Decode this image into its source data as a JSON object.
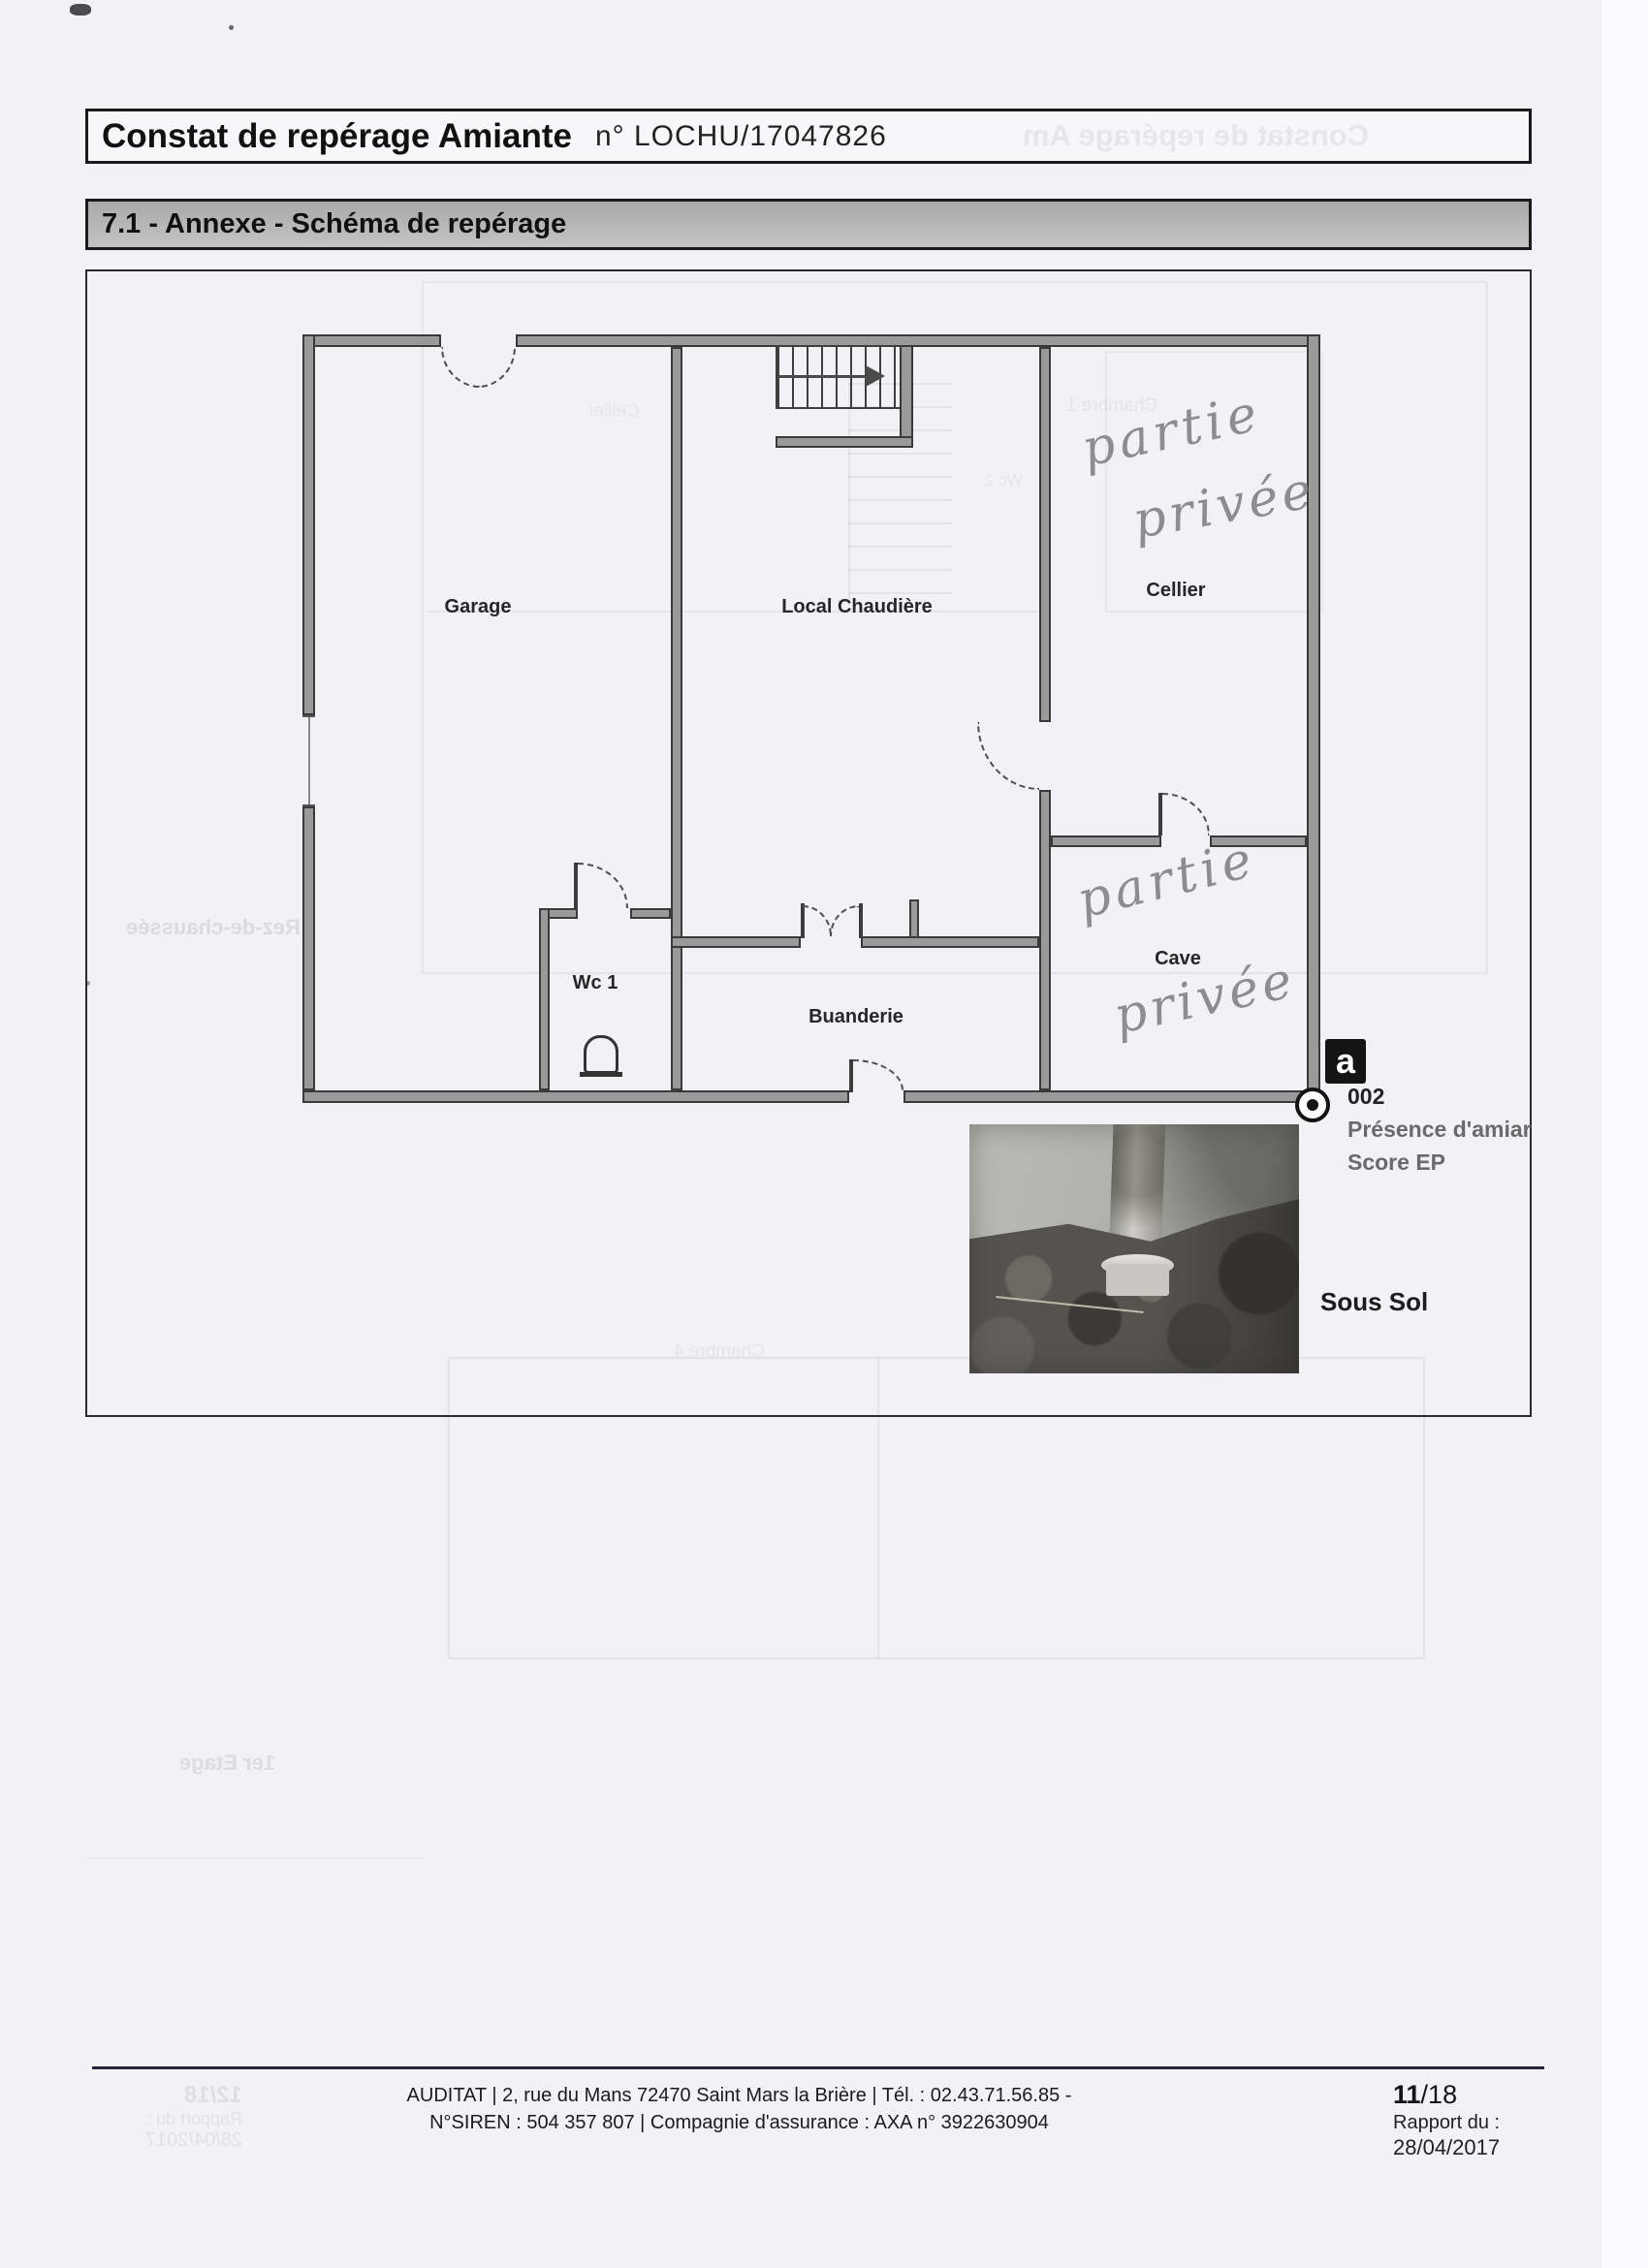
{
  "colors": {
    "paper": "#f1f1f6",
    "ink": "#1a1a1a",
    "wall_fill": "#9a9a9a",
    "wall_edge": "#3a3a3a",
    "section_bar_gray": "#b5b5b5",
    "handwriting_gray": "#76767c",
    "legend_gray": "#6a6a6a"
  },
  "header": {
    "title": "Constat de repérage Amiante",
    "doc_number": "n° LOCHU/17047826"
  },
  "section": {
    "title": "7.1 - Annexe - Schéma de repérage"
  },
  "plan": {
    "rooms": {
      "garage": "Garage",
      "local_chaudiere": "Local Chaudière",
      "cellier": "Cellier",
      "wc1": "Wc 1",
      "buanderie": "Buanderie",
      "cave": "Cave"
    },
    "handwriting": {
      "cellier_word1": "partie",
      "cellier_word2": "privée",
      "cave_word1": "partie",
      "cave_word2": "privée"
    },
    "legend": {
      "marker_letter": "a",
      "marker_id": "002",
      "description_line1": "Présence d'amiar",
      "description_line2": "Score EP"
    },
    "level_label": "Sous Sol"
  },
  "ghosts": {
    "header_title": "Constat de repérage Am",
    "rez_de_chaussee": "Rez-de-chaussée",
    "premier_etage": "1er Etage",
    "chambre1": "Chambre 1",
    "cellier": "Cellier",
    "wc2": "Wc 2",
    "chambre4": "Chambre 4",
    "page_number": "12/18",
    "report_label": "Rapport du :",
    "report_date": "28/04/2017"
  },
  "footer": {
    "line1": "AUDITAT | 2, rue du Mans 72470 Saint Mars la Brière | Tél. : 02.43.71.56.85 -",
    "line2": "N°SIREN : 504 357 807 | Compagnie d'assurance : AXA n° 3922630904",
    "page_current": "11",
    "page_total": "/18",
    "report_label": "Rapport du :",
    "report_date": "28/04/2017"
  }
}
